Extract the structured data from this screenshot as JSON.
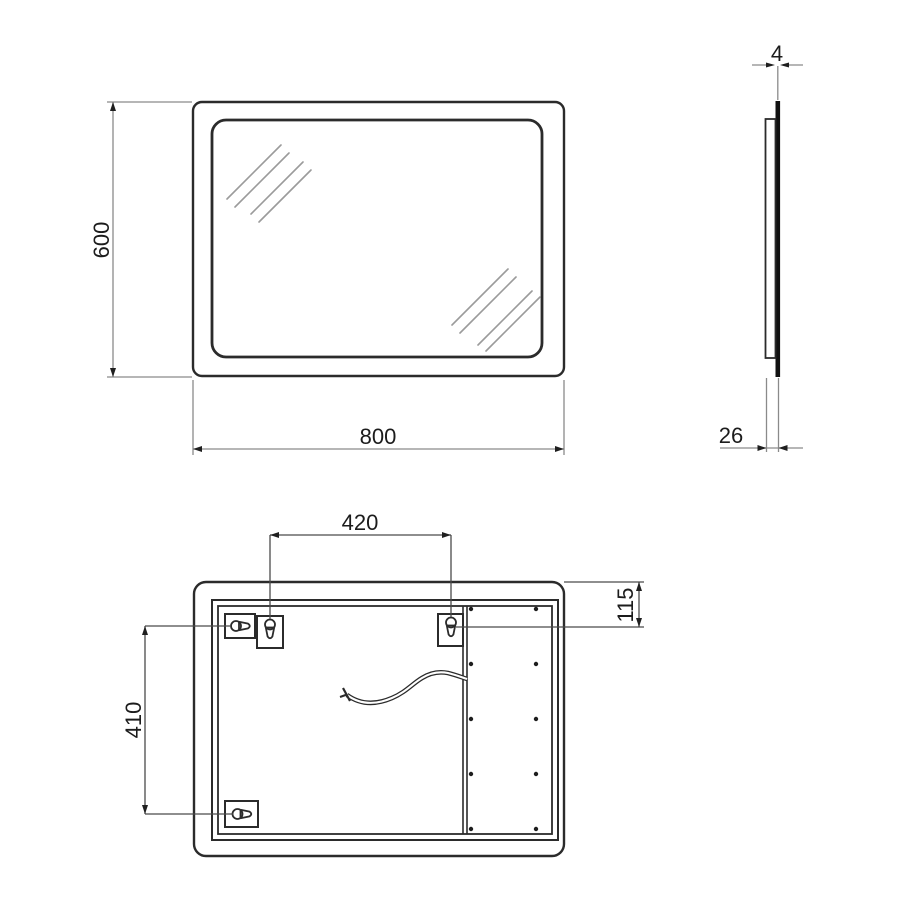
{
  "drawing": {
    "type": "mirror-technical-drawing",
    "dimensions": {
      "front_height": "600",
      "front_width": "800",
      "side_thickness": "4",
      "side_depth": "26",
      "back_mount_spacing": "420",
      "back_mount_vertical": "410",
      "back_top_offset": "115"
    },
    "colors": {
      "frame_fill": "#cdcdcd",
      "outline": "#2b2b2b",
      "dim_line_front": "#8a8a8a",
      "dim_line_back": "#4a4a4a",
      "text": "#1c1c1c",
      "hatch": "#9b9b9b",
      "screw_dot": "#1d1d1d",
      "glass_edge": "#111111",
      "background": "#ffffff"
    }
  }
}
